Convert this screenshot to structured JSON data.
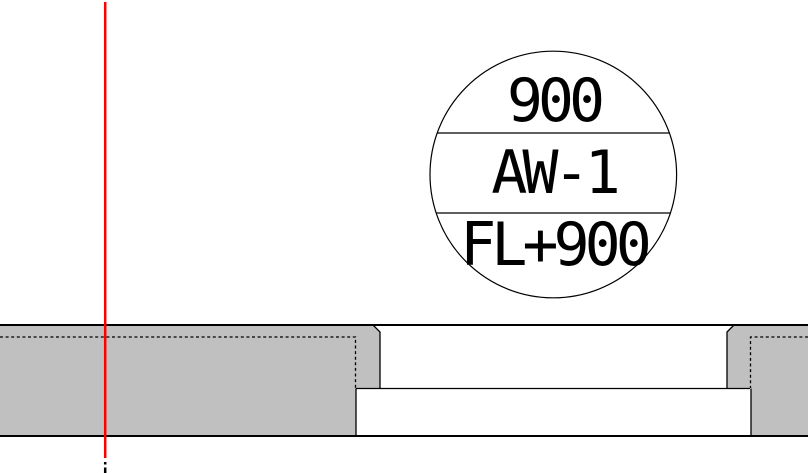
{
  "drawing": {
    "callout": {
      "width": "900",
      "code": "AW-1",
      "level": "FL+900"
    },
    "colors": {
      "wall_fill": "#c0c0c0",
      "outline": "#000000",
      "reference_line": "#ff0000",
      "background": "#ffffff"
    }
  }
}
